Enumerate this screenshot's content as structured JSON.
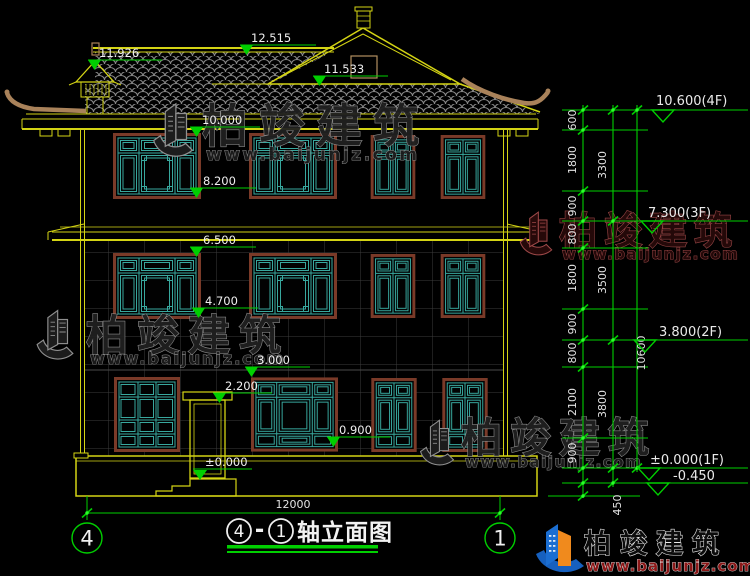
{
  "title": {
    "axis_start": "4",
    "separator": "-",
    "axis_end": "1",
    "name": "轴立面图"
  },
  "axis_bubbles": {
    "left": "4",
    "right": "1"
  },
  "elevations_left": [
    "12.515",
    "11.926",
    "11.533",
    "10.000",
    "8.200",
    "6.500",
    "4.700",
    "3.000",
    "2.200",
    "0.900",
    "±0.000"
  ],
  "elevations_right": [
    "10.600(4F)",
    "7.300(3F)",
    "3.800(2F)",
    "±0.000(1F)",
    "-0.450"
  ],
  "dims": {
    "floor_segments": [
      "600",
      "1800",
      "900",
      "800",
      "1800",
      "900",
      "800",
      "2100",
      "900"
    ],
    "foundation_segment": "450",
    "group_segments": [
      "3300",
      "3500",
      "3800"
    ],
    "total_height": "10600",
    "overall_width": "12000"
  },
  "watermark": {
    "name": "柏竣建筑",
    "url": "www.baijunjz.com"
  },
  "brand": {
    "name": "柏竣建筑",
    "url": "www.baijunjz.com"
  },
  "colors": {
    "line_yellow": "#d4d414",
    "dim_green": "#00cf00",
    "lattice_teal": "#38a89e",
    "frame_maroon": "#7a3a28",
    "ornament_brown": "#a9825a"
  }
}
